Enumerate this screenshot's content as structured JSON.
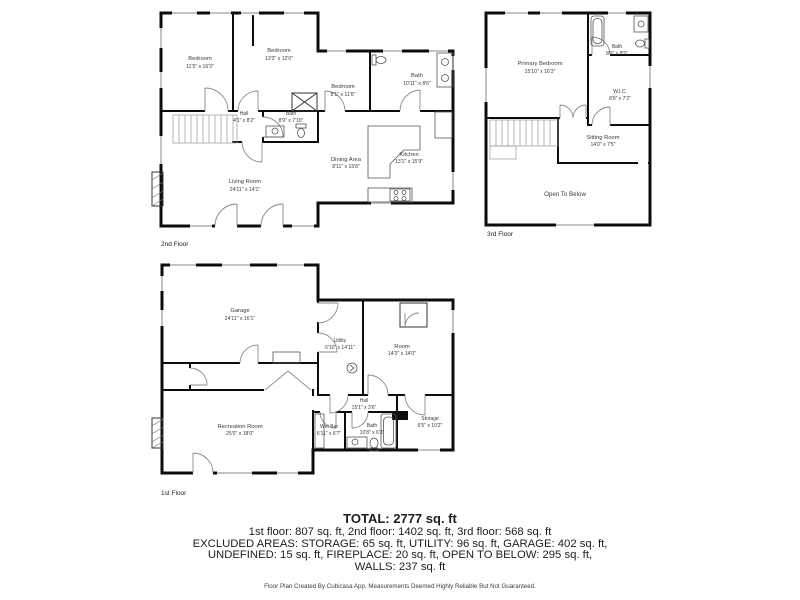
{
  "colors": {
    "wall": "#0c0c0c",
    "window": "#c3c3c3",
    "label_text": "#3a3a3a",
    "summary_text": "#1d1d1d"
  },
  "floors": {
    "f2": {
      "label": "2nd Floor",
      "rooms": {
        "bedroom1": {
          "name": "Bedroom",
          "dims": "11'5\" x 16'3\""
        },
        "bedroom2": {
          "name": "Bedroom",
          "dims": "13'3\" x 12'0\""
        },
        "bedroom3": {
          "name": "Bedroom",
          "dims": "8'1\" x 11'6\""
        },
        "bath_main": {
          "name": "Bath",
          "dims": "10'11\" x 8'6\""
        },
        "hall": {
          "name": "Hall",
          "dims": "4'1\" x 8'2\""
        },
        "bath_hall": {
          "name": "Bath",
          "dims": "8'9\" x 7'10\""
        },
        "living_room": {
          "name": "Living Room",
          "dims": "24'11\" x 14'1\""
        },
        "dining_area": {
          "name": "Dining Area",
          "dims": "8'11\" x 15'8\""
        },
        "kitchen": {
          "name": "Kitchen",
          "dims": "13'1\" x 15'9\""
        }
      }
    },
    "f3": {
      "label": "3rd Floor",
      "rooms": {
        "primary_bedroom": {
          "name": "Primary Bedroom",
          "dims": "15'10\" x 16'3\""
        },
        "bath": {
          "name": "Bath",
          "dims": "8'9\" x 8'9\""
        },
        "wic": {
          "name": "W.I.C.",
          "dims": "8'9\" x 7'2\""
        },
        "sitting_room": {
          "name": "Sitting Room",
          "dims": "14'0\" x 7'5\""
        },
        "open_to_below": {
          "name": "Open To Below"
        }
      }
    },
    "f1": {
      "label": "1st Floor",
      "rooms": {
        "garage": {
          "name": "Garage",
          "dims": "24'11\" x 16'1\""
        },
        "utility": {
          "name": "Utility",
          "dims": "6'10\" x 14'11\""
        },
        "room": {
          "name": "Room",
          "dims": "14'3\" x 14'0\""
        },
        "recreation_room": {
          "name": "Recreation Room",
          "dims": "25'0\" x 18'0\""
        },
        "hall": {
          "name": "Hall",
          "dims": "15'1\" x 3'6\""
        },
        "wet_bar": {
          "name": "Wet Bar",
          "dims": "6'11\" x 6'7\""
        },
        "bath": {
          "name": "Bath",
          "dims": "10'8\" x 6'3\""
        },
        "storage": {
          "name": "Storage",
          "dims": "6'5\" x 10'2\""
        }
      }
    }
  },
  "summary": {
    "total": "TOTAL: 2777 sq. ft",
    "line1": "1st floor: 807 sq. ft, 2nd floor: 1402 sq. ft, 3rd floor: 568 sq. ft",
    "line2": "EXCLUDED AREAS: STORAGE: 65 sq. ft, UTILITY: 96 sq. ft, GARAGE: 402 sq. ft,",
    "line3": "UNDEFINED: 15 sq. ft, FIREPLACE: 20 sq. ft, OPEN TO BELOW: 295 sq. ft,",
    "line4": "WALLS: 237 sq. ft"
  },
  "credit": "Floor Plan Created By Cubicasa App. Measurements Deemed Highly Reliable But Not Guaranteed."
}
